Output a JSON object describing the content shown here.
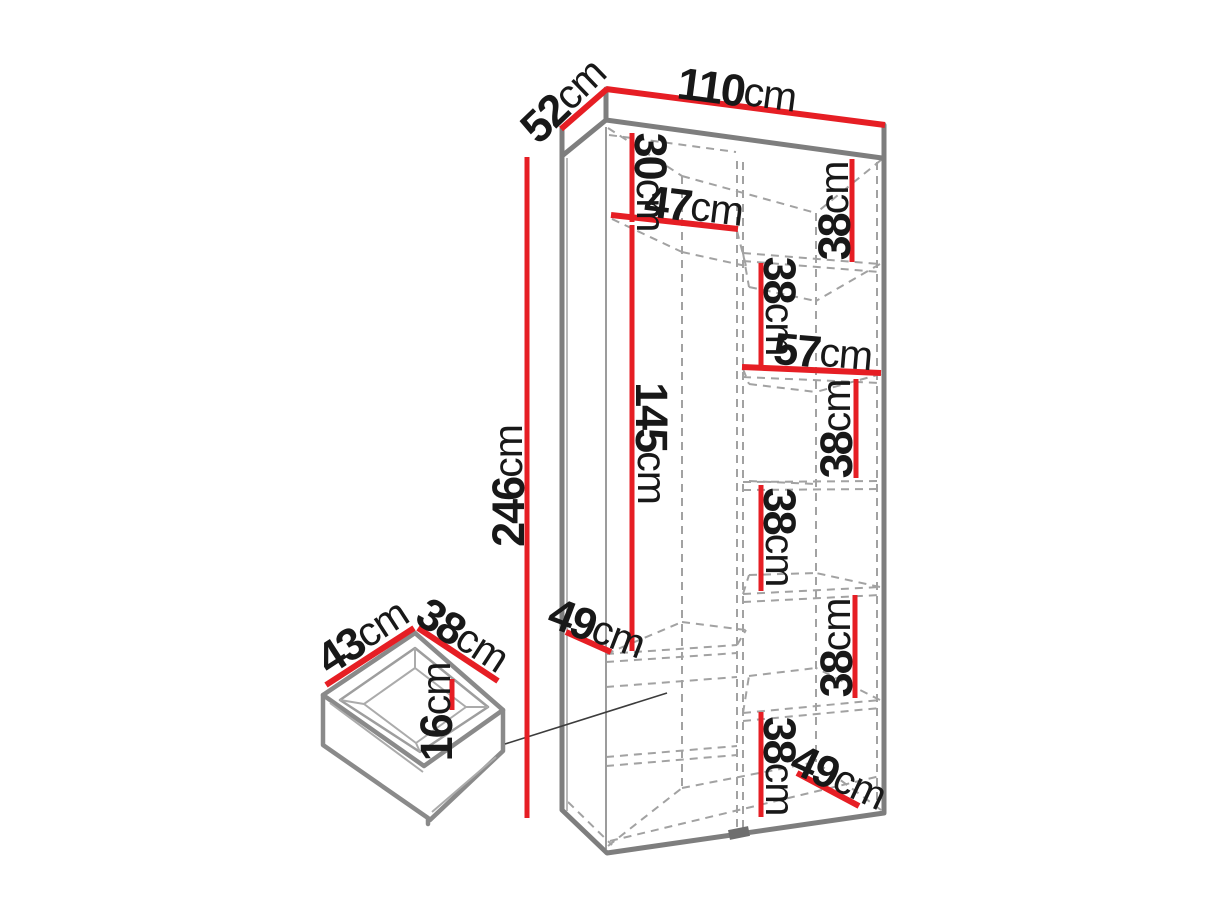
{
  "diagram": {
    "type": "furniture-dimension-diagram",
    "subject": "tall two-section wardrobe with shelves and inset drawer detail",
    "unit": "cm",
    "accent_color": "#e61e24",
    "outline_color": "#7e7e7e",
    "dimensions": {
      "width": {
        "num": "110",
        "unit": "cm"
      },
      "depth": {
        "num": "52",
        "unit": "cm"
      },
      "height": {
        "num": "246",
        "unit": "cm"
      },
      "top_shelf_height": {
        "num": "30",
        "unit": "cm"
      },
      "left_section_width": {
        "num": "47",
        "unit": "cm"
      },
      "right_section_width": {
        "num": "57",
        "unit": "cm"
      },
      "hanging_height": {
        "num": "145",
        "unit": "cm"
      },
      "left_shelf_depth": {
        "num": "49",
        "unit": "cm"
      },
      "bottom_shelf_depth": {
        "num": "49",
        "unit": "cm"
      },
      "shelf_gaps": [
        {
          "num": "38",
          "unit": "cm"
        },
        {
          "num": "38",
          "unit": "cm"
        },
        {
          "num": "38",
          "unit": "cm"
        },
        {
          "num": "38",
          "unit": "cm"
        },
        {
          "num": "38",
          "unit": "cm"
        },
        {
          "num": "38",
          "unit": "cm"
        }
      ]
    },
    "drawer": {
      "width": {
        "num": "43",
        "unit": "cm"
      },
      "depth": {
        "num": "38",
        "unit": "cm"
      },
      "inner_height": {
        "num": "16",
        "unit": "cm"
      }
    }
  }
}
